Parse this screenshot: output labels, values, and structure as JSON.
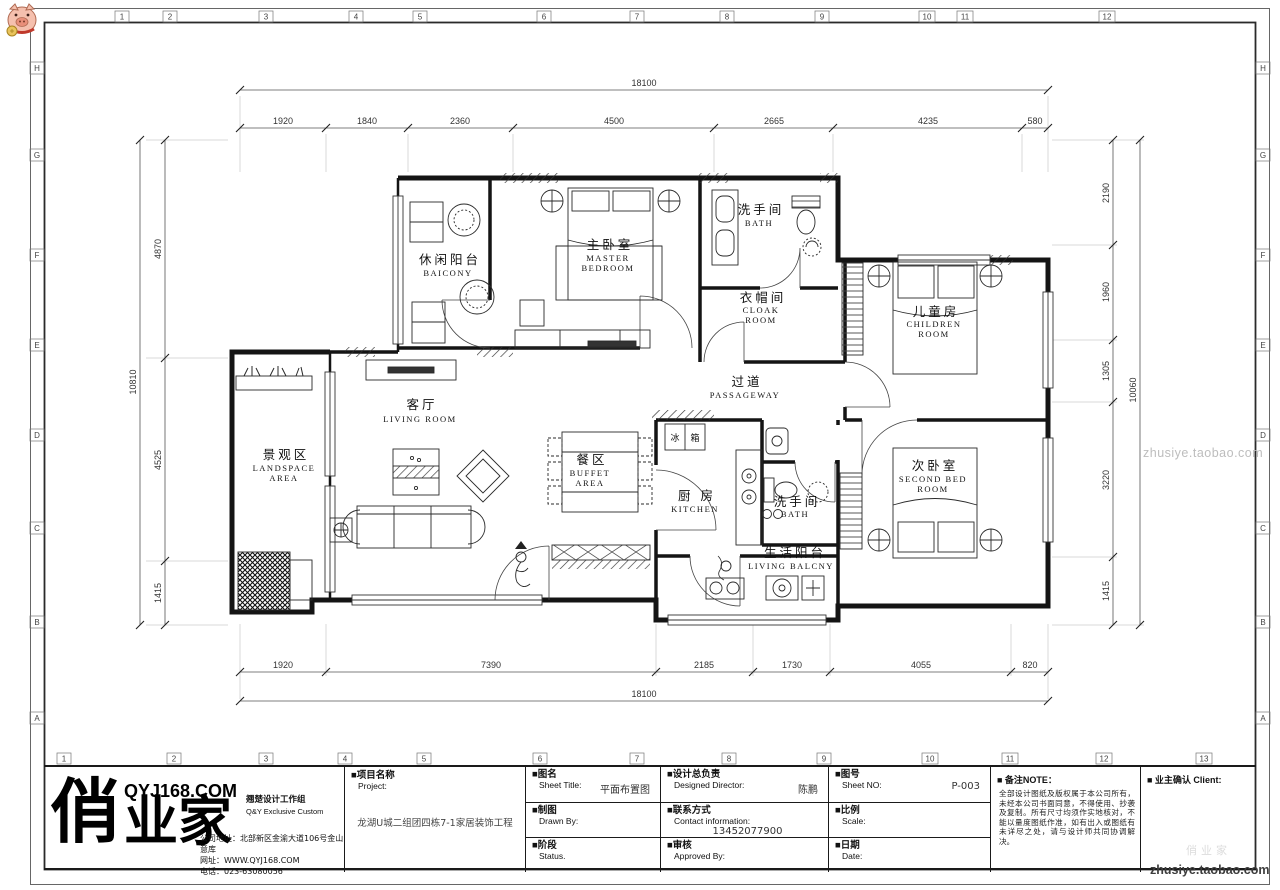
{
  "frame": {
    "grid_top": [
      "1",
      "2",
      "3",
      "4",
      "5",
      "6",
      "7",
      "8",
      "9",
      "10",
      "11",
      "12"
    ],
    "grid_bottom": [
      "1",
      "2",
      "3",
      "4",
      "5",
      "6",
      "7",
      "8",
      "9",
      "10",
      "11",
      "12",
      "13"
    ],
    "grid_left": [
      "H",
      "G",
      "F",
      "E",
      "D",
      "C",
      "B",
      "A"
    ],
    "grid_right": [
      "H",
      "G",
      "F",
      "E",
      "D",
      "C",
      "B",
      "A"
    ]
  },
  "dims": {
    "top": {
      "total": "18100",
      "segments": [
        "1920",
        "1840",
        "2360",
        "4500",
        "2665",
        "4235",
        "580"
      ]
    },
    "bottom": {
      "total": "18100",
      "segments": [
        "1920",
        "7390",
        "2185",
        "1730",
        "4055",
        "820"
      ]
    },
    "left": {
      "total": "10810",
      "segments": [
        "4870",
        "4525",
        "1415"
      ]
    },
    "right": {
      "total": "10060",
      "segments": [
        "2190",
        "1960",
        "1305",
        "3220",
        "1415"
      ]
    }
  },
  "rooms": [
    {
      "cn": "休闲阳台",
      "en": "BAICONY"
    },
    {
      "cn": "主卧室",
      "en": "MASTER",
      "en2": "BEDROOM"
    },
    {
      "cn": "洗手间",
      "en": "BATH"
    },
    {
      "cn": "衣帽间",
      "en": "CLOAK",
      "en2": "ROOM"
    },
    {
      "cn": "儿童房",
      "en": "CHILDREN",
      "en2": "ROOM"
    },
    {
      "cn": "过道",
      "en": "PASSAGEWAY"
    },
    {
      "cn": "客厅",
      "en": "LIVING  ROOM"
    },
    {
      "cn": "景观区",
      "en": "LANDSPACE",
      "en2": "AREA"
    },
    {
      "cn": "餐区",
      "en": "BUFFET",
      "en2": "AREA"
    },
    {
      "cn": "厨 房",
      "en": "KITCHEN"
    },
    {
      "cn": "洗手间",
      "en": "BATH"
    },
    {
      "cn": "次卧室",
      "en": "SECOND  BED",
      "en2": "ROOM"
    },
    {
      "cn": "生活阳台",
      "en": "LIVING  BALCNY"
    }
  ],
  "fixtures": {
    "fridge_left": "冰",
    "fridge_right": "箱"
  },
  "watermark": {
    "text": "zhusiye.taobao.com",
    "stamp": "俏业家"
  },
  "title_block": {
    "project": {
      "cn": "■项目名称",
      "en": "Project:",
      "value": "龙湖U城二组团四栋7-1家居装饰工程"
    },
    "sheet_title": {
      "cn": "■图名",
      "en": "Sheet Title:",
      "value": "平面布置图"
    },
    "drawn_by": {
      "cn": "■制图",
      "en": "Drawn By:"
    },
    "status": {
      "cn": "■阶段",
      "en": "Status."
    },
    "director": {
      "cn": "■设计总负责",
      "en": "Designed Director:",
      "value": "陈鹏"
    },
    "contact": {
      "cn": "■联系方式",
      "en": "Contact information:",
      "value": "13452077900"
    },
    "approved": {
      "cn": "■审核",
      "en": "Approved By:"
    },
    "sheet_no": {
      "cn": "■图号",
      "en": "Sheet NO:",
      "value": "P-003"
    },
    "scale": {
      "cn": "■比例",
      "en": "Scale:"
    },
    "date": {
      "cn": "■日期",
      "en": "Date:"
    },
    "note": {
      "label": "■ 备注NOTE：",
      "text": "全部设计图纸及版权属于本公司所有，未经本公司书面同意，不得使用、抄袭及复制。所有尺寸均须作实地核对，不能以量度图纸作准，如有出入或图纸有未详尽之处，请与设计师共同协调解决。"
    },
    "client": {
      "label": "■ 业主确认 Client:"
    },
    "logo": {
      "c1": "俏",
      "c23": "业家",
      "site": "QYJ168.COM",
      "studio_cn": "翘楚设计工作组",
      "studio_en": "Q&Y Exclusive Custom",
      "address": "公司地址：北部新区金渝大道106号金山意库",
      "web": "网址：WWW.QYJ168.COM",
      "tel": "电话：023-63080056"
    }
  }
}
